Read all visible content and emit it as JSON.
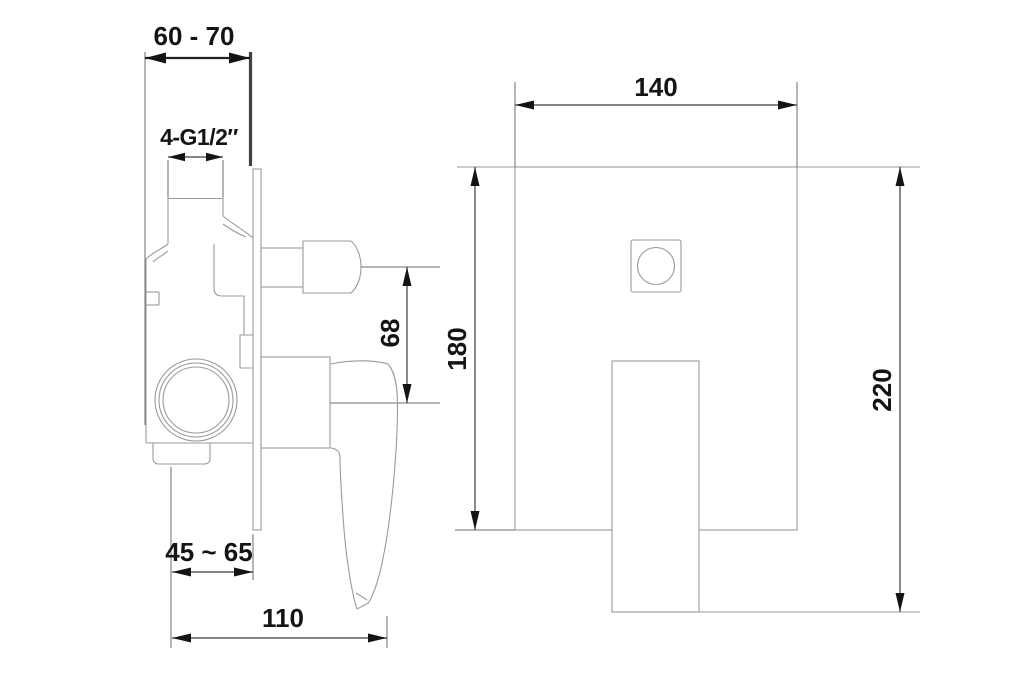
{
  "drawing": {
    "type": "technical-dimension-drawing",
    "subject": "Concealed wall-mounted single-lever shower mixer — side installation view and front view",
    "units": "mm",
    "colors": {
      "background": "#ffffff",
      "linework": "#9a9a9a",
      "dimension_lines": "#3c3c3c",
      "text": "#141414"
    },
    "side_view": {
      "labels": {
        "wall_depth_range": "60 - 70",
        "thread_size": "4-G1/2″",
        "handle_axis_offset": "68",
        "rough_in_range": "45 ~ 65",
        "handle_projection": "110"
      }
    },
    "front_view": {
      "labels": {
        "plate_width": "140",
        "plate_height": "180",
        "overall_height": "220"
      }
    }
  }
}
